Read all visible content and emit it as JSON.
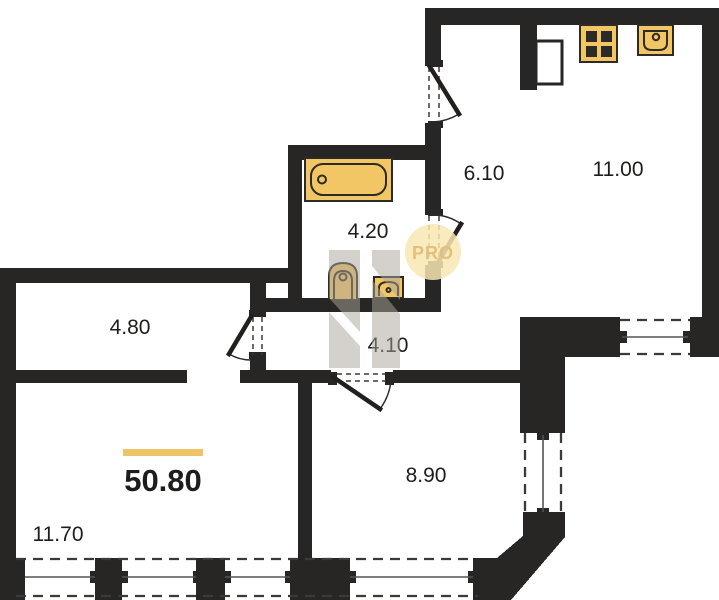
{
  "plan": {
    "title": "apartment-floor-plan",
    "total": {
      "area": "50.80"
    },
    "rooms": [
      {
        "name": "entry-hall",
        "area": "6.10"
      },
      {
        "name": "kitchen-living",
        "area": "11.00"
      },
      {
        "name": "bathroom",
        "area": "4.20"
      },
      {
        "name": "corridor",
        "area": "4.10"
      },
      {
        "name": "wardrobe",
        "area": "4.80"
      },
      {
        "name": "bedroom",
        "area": "8.90"
      },
      {
        "name": "living-room",
        "area": "11.70"
      }
    ],
    "fixtures": [
      "bathtub",
      "toilet",
      "wash-basin",
      "kitchen-sink",
      "stove"
    ],
    "watermark": {
      "badge_text": "PRO"
    },
    "colors": {
      "wall": "#272624",
      "accent": "#EFC464",
      "fixture_fill": "#F2C664",
      "fixture_stroke": "#2c2b28",
      "dash": "#3b3a37",
      "label": "#1d1d1b",
      "badge_bg": "#F9E7B4",
      "badge_text": "#E2C07A",
      "watermark_gray": "#ABA49B"
    }
  }
}
